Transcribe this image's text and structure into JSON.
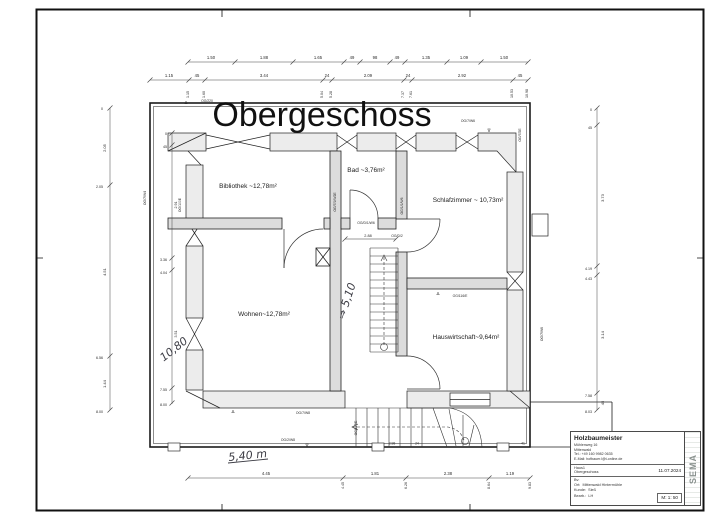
{
  "drawing": {
    "title": "Obergeschoss",
    "scale": "M: 1: 50",
    "date": "11.07.2024"
  },
  "title_block": {
    "company": "Holzbaumeister",
    "address1": "Mühlenweg 16",
    "address2": "Mittenwald",
    "phone": "Tel.: +49 160 9982 0635",
    "email": "E-Mail: hofbauer.l@t-online.de",
    "project": "Haus1",
    "floor": "Obergeschoss",
    "date": "11.07.2024",
    "bv_label": "Bv:",
    "ort_label": "Ort:",
    "ort_value": "Mittenwald Hintermühle",
    "kunde_label": "Kunde:",
    "kunde_value": "Sieß",
    "bearb_label": "Bearb.:",
    "bearb_value": "LH",
    "scale": "M: 1: 50",
    "logo": "SEMA"
  },
  "labels": [
    {
      "n": "drawing-title",
      "t": "Obergeschoss",
      "x": 322,
      "y": 126,
      "fs": 34,
      "c": "title"
    },
    {
      "n": "room-label-bibliothek",
      "t": "Bibliothek ~12,78m²",
      "x": 248,
      "y": 188,
      "fs": 6.5,
      "c": "room"
    },
    {
      "n": "room-label-bad",
      "t": "Bad ~3,76m²",
      "x": 366,
      "y": 172,
      "fs": 6.5,
      "c": "room"
    },
    {
      "n": "room-label-schlafzimmer",
      "t": "Schlafzimmer ~ 10,73m²",
      "x": 468,
      "y": 202,
      "fs": 6.5,
      "c": "room"
    },
    {
      "n": "room-label-wohnen",
      "t": "Wohnen~12,78m²",
      "x": 264,
      "y": 316,
      "fs": 6.5,
      "c": "room"
    },
    {
      "n": "room-label-hauswirtschaft",
      "t": "Hauswirtschaft~9,64m²",
      "x": 466,
      "y": 339,
      "fs": 6.5,
      "c": "room"
    },
    {
      "n": "dim-label",
      "t": "1.50",
      "x": 211,
      "y": 59,
      "fs": 4.2,
      "c": "dim"
    },
    {
      "n": "dim-label",
      "t": "1.88",
      "x": 264,
      "y": 59,
      "fs": 4.2,
      "c": "dim"
    },
    {
      "n": "dim-label",
      "t": "1.65",
      "x": 318,
      "y": 59,
      "fs": 4.2,
      "c": "dim"
    },
    {
      "n": "dim-label",
      "t": "49",
      "x": 352,
      "y": 59,
      "fs": 4.2,
      "c": "dim"
    },
    {
      "n": "dim-label",
      "t": "98",
      "x": 375,
      "y": 59,
      "fs": 4.2,
      "c": "dim"
    },
    {
      "n": "dim-label",
      "t": "49",
      "x": 397,
      "y": 59,
      "fs": 4.2,
      "c": "dim"
    },
    {
      "n": "dim-label",
      "t": "1.35",
      "x": 426,
      "y": 59,
      "fs": 4.2,
      "c": "dim"
    },
    {
      "n": "dim-label",
      "t": "1.09",
      "x": 464,
      "y": 59,
      "fs": 4.2,
      "c": "dim"
    },
    {
      "n": "dim-label",
      "t": "1.50",
      "x": 504,
      "y": 59,
      "fs": 4.2,
      "c": "dim"
    },
    {
      "n": "dim-label",
      "t": "1.15",
      "x": 169,
      "y": 77,
      "fs": 4.2,
      "c": "dim"
    },
    {
      "n": "dim-label",
      "t": "45",
      "x": 197,
      "y": 77,
      "fs": 4.2,
      "c": "dim"
    },
    {
      "n": "dim-label",
      "t": "3.44",
      "x": 264,
      "y": 77,
      "fs": 4.2,
      "c": "dim"
    },
    {
      "n": "dim-label",
      "t": "24",
      "x": 327,
      "y": 77,
      "fs": 4.2,
      "c": "dim"
    },
    {
      "n": "dim-label",
      "t": "2.09",
      "x": 368,
      "y": 77,
      "fs": 4.2,
      "c": "dim"
    },
    {
      "n": "dim-label",
      "t": "24",
      "x": 408,
      "y": 77,
      "fs": 4.2,
      "c": "dim"
    },
    {
      "n": "dim-label",
      "t": "2.92",
      "x": 462,
      "y": 77,
      "fs": 4.2,
      "c": "dim"
    },
    {
      "n": "dim-label",
      "t": "45",
      "x": 520,
      "y": 77,
      "fs": 4.2,
      "c": "dim"
    },
    {
      "n": "dim-cum-label",
      "t": "1.15",
      "x": 189,
      "y": 98,
      "r": -90,
      "fs": 3.6,
      "c": "dim",
      "a": "s"
    },
    {
      "n": "dim-cum-label",
      "t": "1.60",
      "x": 205,
      "y": 98,
      "r": -90,
      "fs": 3.6,
      "c": "dim",
      "a": "s"
    },
    {
      "n": "dim-cum-label",
      "t": "5.04",
      "x": 323,
      "y": 98,
      "r": -90,
      "fs": 3.6,
      "c": "dim",
      "a": "s"
    },
    {
      "n": "dim-cum-label",
      "t": "5.28",
      "x": 332,
      "y": 98,
      "r": -90,
      "fs": 3.6,
      "c": "dim",
      "a": "s"
    },
    {
      "n": "dim-cum-label",
      "t": "7.37",
      "x": 404,
      "y": 98,
      "r": -90,
      "fs": 3.6,
      "c": "dim",
      "a": "s"
    },
    {
      "n": "dim-cum-label",
      "t": "7.61",
      "x": 412,
      "y": 98,
      "r": -90,
      "fs": 3.6,
      "c": "dim",
      "a": "s"
    },
    {
      "n": "dim-cum-label",
      "t": "10.53",
      "x": 513,
      "y": 98,
      "r": -90,
      "fs": 3.6,
      "c": "dim",
      "a": "s"
    },
    {
      "n": "dim-cum-label",
      "t": "10.98",
      "x": 528,
      "y": 98,
      "r": -90,
      "fs": 3.6,
      "c": "dim",
      "a": "s"
    },
    {
      "n": "dim-label",
      "t": "2.05",
      "x": 106,
      "y": 148,
      "r": -90,
      "fs": 4,
      "c": "dim"
    },
    {
      "n": "dim-label",
      "t": "4.51",
      "x": 106,
      "y": 272,
      "r": -90,
      "fs": 4,
      "c": "dim"
    },
    {
      "n": "dim-label",
      "t": "1.44",
      "x": 106,
      "y": 384,
      "r": -90,
      "fs": 4,
      "c": "dim"
    },
    {
      "n": "dim-cum-label",
      "t": "0",
      "x": 103,
      "y": 110,
      "fs": 3.6,
      "c": "dim",
      "a": "e"
    },
    {
      "n": "dim-cum-label",
      "t": "2.05",
      "x": 103,
      "y": 188,
      "fs": 3.6,
      "c": "dim",
      "a": "e"
    },
    {
      "n": "dim-cum-label",
      "t": "6.56",
      "x": 103,
      "y": 359,
      "fs": 3.6,
      "c": "dim",
      "a": "e"
    },
    {
      "n": "dim-cum-label",
      "t": "8.00",
      "x": 103,
      "y": 413,
      "fs": 3.6,
      "c": "dim",
      "a": "e"
    },
    {
      "n": "dim-cum-label",
      "t": "0",
      "x": 167,
      "y": 135,
      "fs": 3.6,
      "c": "dim",
      "a": "e"
    },
    {
      "n": "dim-cum-label",
      "t": "45",
      "x": 167,
      "y": 148,
      "fs": 3.6,
      "c": "dim",
      "a": "e"
    },
    {
      "n": "dim-cum-label",
      "t": "3.36",
      "x": 167,
      "y": 261,
      "fs": 3.6,
      "c": "dim",
      "a": "e"
    },
    {
      "n": "dim-cum-label",
      "t": "4.04",
      "x": 167,
      "y": 274,
      "fs": 3.6,
      "c": "dim",
      "a": "e"
    },
    {
      "n": "dim-cum-label",
      "t": "7.55",
      "x": 167,
      "y": 391,
      "fs": 3.6,
      "c": "dim",
      "a": "e"
    },
    {
      "n": "dim-cum-label",
      "t": "8.00",
      "x": 167,
      "y": 406,
      "fs": 3.6,
      "c": "dim",
      "a": "e"
    },
    {
      "n": "dim-label",
      "t": "2.91",
      "x": 177,
      "y": 205,
      "r": -90,
      "fs": 3.6,
      "c": "dim"
    },
    {
      "n": "dim-label",
      "t": "3.51",
      "x": 177,
      "y": 334,
      "r": -90,
      "fs": 3.6,
      "c": "dim"
    },
    {
      "n": "dim-cum-label",
      "t": "0",
      "x": 592,
      "y": 111,
      "fs": 3.6,
      "c": "dim",
      "a": "e"
    },
    {
      "n": "dim-cum-label",
      "t": "45",
      "x": 592,
      "y": 129,
      "fs": 3.6,
      "c": "dim",
      "a": "e"
    },
    {
      "n": "dim-cum-label",
      "t": "4.19",
      "x": 592,
      "y": 270,
      "fs": 3.6,
      "c": "dim",
      "a": "e"
    },
    {
      "n": "dim-cum-label",
      "t": "4.43",
      "x": 592,
      "y": 280,
      "fs": 3.6,
      "c": "dim",
      "a": "e"
    },
    {
      "n": "dim-cum-label",
      "t": "7.58",
      "x": 592,
      "y": 397,
      "fs": 3.6,
      "c": "dim",
      "a": "e"
    },
    {
      "n": "dim-cum-label",
      "t": "8.03",
      "x": 592,
      "y": 413,
      "fs": 3.6,
      "c": "dim",
      "a": "e"
    },
    {
      "n": "dim-label",
      "t": "3.73",
      "x": 604,
      "y": 198,
      "r": -90,
      "fs": 4,
      "c": "dim"
    },
    {
      "n": "dim-label",
      "t": "3.14",
      "x": 604,
      "y": 335,
      "r": -90,
      "fs": 4,
      "c": "dim"
    },
    {
      "n": "dim-label",
      "t": "45",
      "x": 604,
      "y": 403,
      "r": -90,
      "fs": 4,
      "c": "dim"
    },
    {
      "n": "dim-label",
      "t": "4.45",
      "x": 266,
      "y": 475,
      "fs": 4.2,
      "c": "dim"
    },
    {
      "n": "dim-label",
      "t": "1.81",
      "x": 375,
      "y": 475,
      "fs": 4.2,
      "c": "dim"
    },
    {
      "n": "dim-label",
      "t": "2.38",
      "x": 448,
      "y": 475,
      "fs": 4.2,
      "c": "dim"
    },
    {
      "n": "dim-label",
      "t": "1.19",
      "x": 510,
      "y": 475,
      "fs": 4.2,
      "c": "dim"
    },
    {
      "n": "dim-cum-label",
      "t": "4.45",
      "x": 344,
      "y": 482,
      "r": -90,
      "fs": 3.6,
      "c": "dim",
      "a": "e"
    },
    {
      "n": "dim-cum-label",
      "t": "6.26",
      "x": 407,
      "y": 482,
      "r": -90,
      "fs": 3.6,
      "c": "dim",
      "a": "e"
    },
    {
      "n": "dim-cum-label",
      "t": "8.64",
      "x": 490,
      "y": 482,
      "r": -90,
      "fs": 3.6,
      "c": "dim",
      "a": "e"
    },
    {
      "n": "dim-cum-label",
      "t": "9.83",
      "x": 531,
      "y": 482,
      "r": -90,
      "fs": 3.6,
      "c": "dim",
      "a": "e"
    },
    {
      "n": "dim-label",
      "t": "2.88",
      "x": 368,
      "y": 237,
      "fs": 3.8,
      "c": "dim"
    },
    {
      "n": "dim-label",
      "t": "2.98",
      "x": 392,
      "y": 444.5,
      "fs": 3.4,
      "c": "dim"
    },
    {
      "n": "dim-label",
      "t": "24",
      "x": 417,
      "y": 444.5,
      "fs": 3.4,
      "c": "dim"
    },
    {
      "n": "dim-label",
      "t": "41",
      "x": 523,
      "y": 444.5,
      "fs": 3.4,
      "c": "dim"
    },
    {
      "n": "wall-id",
      "t": "OG/220",
      "x": 207,
      "y": 102,
      "fs": 3.4,
      "c": "dim"
    },
    {
      "n": "wall-id",
      "t": "OG/7/W6",
      "x": 468,
      "y": 122,
      "fs": 3.4,
      "c": "dim"
    },
    {
      "n": "wall-id",
      "t": "OG/7/2E",
      "x": 521,
      "y": 135,
      "r": -90,
      "fs": 3.4,
      "c": "dim"
    },
    {
      "n": "wall-id",
      "t": "OG/7/W4",
      "x": 146,
      "y": 198,
      "r": -90,
      "fs": 3.4,
      "c": "dim"
    },
    {
      "n": "wall-id",
      "t": "OG/100E",
      "x": 181,
      "y": 205,
      "r": -90,
      "fs": 3.4,
      "c": "dim"
    },
    {
      "n": "wall-id",
      "t": "OG/7/1/W2E",
      "x": 336,
      "y": 202,
      "r": -90,
      "fs": 3.4,
      "c": "dim"
    },
    {
      "n": "wall-id",
      "t": "OG/1/1/W6",
      "x": 403,
      "y": 206,
      "r": -90,
      "fs": 3.4,
      "c": "dim"
    },
    {
      "n": "wall-id",
      "t": "OG/D/1/W6",
      "x": 366,
      "y": 224,
      "fs": 3.4,
      "c": "dim"
    },
    {
      "n": "wall-id",
      "t": "OG/D/2",
      "x": 397,
      "y": 237,
      "fs": 3.4,
      "c": "dim"
    },
    {
      "n": "wall-id",
      "t": "OG/116/E",
      "x": 460,
      "y": 297,
      "fs": 3.4,
      "c": "dim"
    },
    {
      "n": "wall-id",
      "t": "OG/7/W6",
      "x": 543,
      "y": 334,
      "r": -90,
      "fs": 3.4,
      "c": "dim"
    },
    {
      "n": "wall-id",
      "t": "OG/7/W8",
      "x": 303,
      "y": 414,
      "fs": 3.4,
      "c": "dim"
    },
    {
      "n": "wall-id",
      "t": "OG/2/W8",
      "x": 288,
      "y": 441,
      "fs": 3.4,
      "c": "dim"
    },
    {
      "n": "wall-id",
      "t": "OG/117/E",
      "x": 357,
      "y": 428,
      "r": -90,
      "fs": 3.4,
      "c": "dim"
    },
    {
      "n": "marker-triangle",
      "t": "Δ",
      "x": 186,
      "y": 104,
      "fs": 4.5,
      "c": "dim"
    },
    {
      "n": "marker-triangle",
      "t": "Δ",
      "x": 438,
      "y": 295,
      "fs": 4.5,
      "c": "dim"
    },
    {
      "n": "marker-triangle",
      "t": "Δ",
      "x": 233,
      "y": 413,
      "fs": 4.5,
      "c": "dim"
    },
    {
      "n": "marker-triangle",
      "t": "∇",
      "x": 307,
      "y": 447,
      "fs": 4.5,
      "c": "dim"
    },
    {
      "n": "marker-triangle",
      "t": "∇",
      "x": 489,
      "y": 132,
      "fs": 4.5,
      "c": "dim"
    },
    {
      "n": "handwritten-10-80",
      "t": "10,80",
      "x": 176,
      "y": 352,
      "r": -38,
      "fs": 11,
      "c": "hand"
    },
    {
      "n": "handwritten-5-10",
      "t": "⇒ 5,10",
      "x": 350,
      "y": 302,
      "r": -72,
      "fs": 11,
      "c": "hand"
    },
    {
      "n": "handwritten-5-40",
      "t": "5,40 m",
      "x": 248,
      "y": 459,
      "r": -6,
      "fs": 11,
      "c": "hand"
    }
  ]
}
